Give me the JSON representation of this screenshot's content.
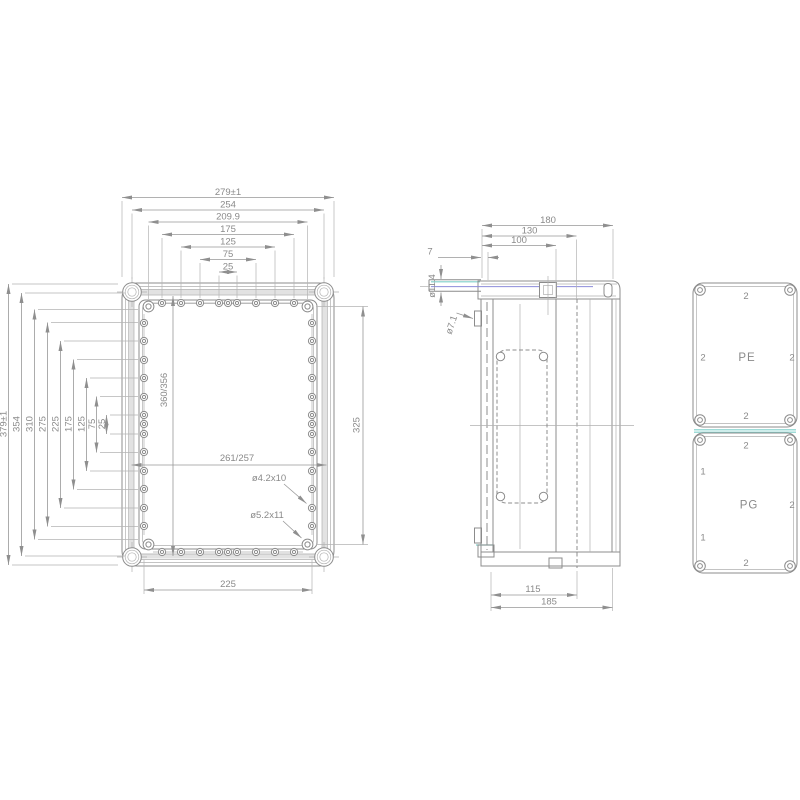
{
  "colors": {
    "line": "#8c8c8c",
    "dimension": "#979797",
    "text": "#8a8a8a",
    "accent_teal": "#7fcfca",
    "accent_blue": "#8c8cd9",
    "seal_band": "#e2e2e2",
    "background": "#ffffff"
  },
  "front_view": {
    "top_dims": [
      "279±1",
      "254",
      "209.9",
      "175",
      "125",
      "75",
      "25"
    ],
    "left_dims": [
      "379±1",
      "354",
      "310",
      "275",
      "225",
      "175",
      "125",
      "75",
      "25"
    ],
    "inner_height_dim": "360/356",
    "inner_width_dim": "261/257",
    "hole_note_small": "ø4.2x10",
    "hole_note_large": "ø5.2x11",
    "right_dim": "325",
    "bottom_dim": "225"
  },
  "side_view": {
    "top_dims": [
      "180",
      "130",
      "100",
      "7"
    ],
    "pin_diameter": "ø11.4",
    "hole_diameter": "ø7.1",
    "bottom_dims": [
      "115",
      "185"
    ]
  },
  "panels": {
    "pe": {
      "title": "PE",
      "top": "2",
      "left": "2",
      "right": "2",
      "bottom": "2"
    },
    "pg": {
      "title": "PG",
      "top": "2",
      "upper_left": "1",
      "lower_left": "1",
      "right": "2",
      "bottom": "2"
    }
  }
}
